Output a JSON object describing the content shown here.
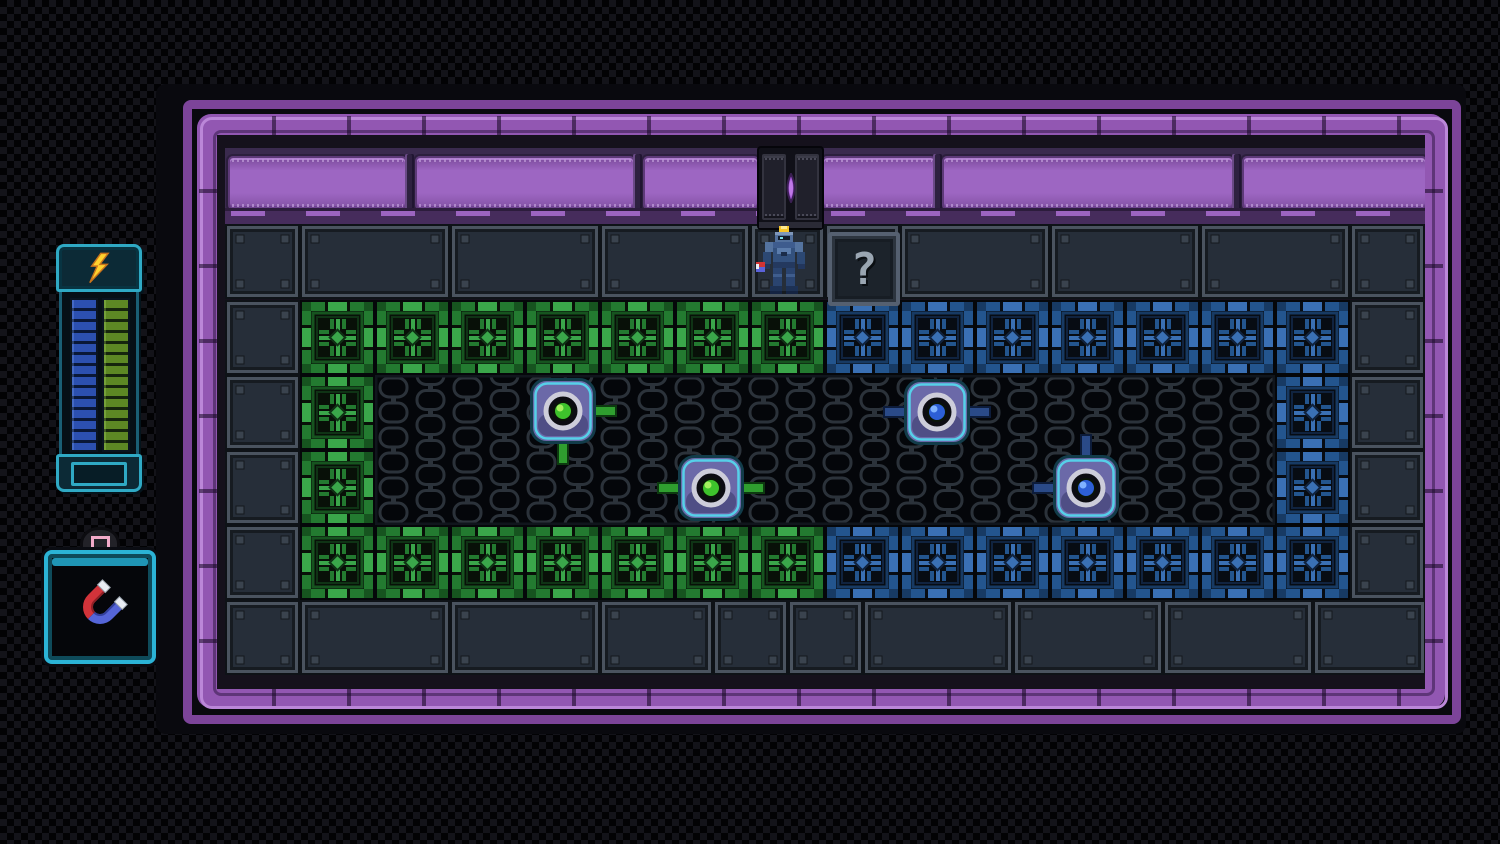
{
  "game": {
    "player": {
      "sprite": "armored-robot",
      "holding": "magnet"
    },
    "mystery_block": {
      "glyph": "?"
    },
    "door": {
      "position": "top-center",
      "state": "closed"
    },
    "orbs": [
      {
        "id": "green-orb-1",
        "core": "green",
        "x": 155,
        "y": 3,
        "connectors": [
          "right",
          "down"
        ]
      },
      {
        "id": "green-orb-2",
        "core": "green",
        "x": 303,
        "y": 80,
        "connectors": [
          "left",
          "right"
        ]
      },
      {
        "id": "blue-orb-1",
        "core": "blue",
        "x": 529,
        "y": 4,
        "connectors": [
          "left",
          "right"
        ]
      },
      {
        "id": "blue-orb-2",
        "core": "blue",
        "x": 678,
        "y": 80,
        "connectors": [
          "up",
          "left"
        ]
      }
    ],
    "hud": {
      "energy_meter": {
        "icon": "lightning-bolt",
        "columns": [
          {
            "name": "blue-energy",
            "color": "#2c50b0"
          },
          {
            "name": "green-energy",
            "color": "#5d8824"
          }
        ]
      },
      "item": {
        "name": "magnet",
        "icon": "magnet",
        "button_icon": "pink-square-button"
      }
    }
  },
  "layout": {
    "unit": 75,
    "rows": {
      "top": [
        {
          "t": "grey",
          "w": 1
        },
        {
          "t": "grey",
          "w": 2
        },
        {
          "t": "grey",
          "w": 2
        },
        {
          "t": "grey",
          "w": 2
        },
        {
          "t": "grey",
          "w": 1
        },
        {
          "t": "grey",
          "w": 1
        },
        {
          "t": "grey",
          "w": 2
        },
        {
          "t": "grey",
          "w": 2
        },
        {
          "t": "grey",
          "w": 2
        },
        {
          "t": "grey",
          "w": 1
        }
      ],
      "upper": [
        {
          "t": "grey",
          "w": 1
        },
        {
          "t": "green",
          "w": 1,
          "n": 7
        },
        {
          "t": "blue",
          "w": 1,
          "n": 7
        },
        {
          "t": "grey",
          "w": 1
        }
      ],
      "lower": [
        {
          "t": "grey",
          "w": 1
        },
        {
          "t": "green",
          "w": 1,
          "n": 7
        },
        {
          "t": "blue",
          "w": 1,
          "n": 7
        },
        {
          "t": "grey",
          "w": 1
        }
      ],
      "bottom": [
        {
          "t": "grey",
          "w": 1
        },
        {
          "t": "grey",
          "w": 2
        },
        {
          "t": "grey",
          "w": 2
        },
        {
          "t": "grey",
          "w": 1.5
        },
        {
          "t": "grey",
          "w": 1
        },
        {
          "t": "grey",
          "w": 1
        },
        {
          "t": "grey",
          "w": 2
        },
        {
          "t": "grey",
          "w": 2
        },
        {
          "t": "grey",
          "w": 2
        },
        {
          "t": "grey",
          "w": 1.5
        }
      ]
    },
    "middle_left_columns": [
      "grey",
      "green"
    ],
    "middle_right_columns": [
      "blue",
      "grey"
    ],
    "banner_panels": [
      {
        "x": 3,
        "w": 175
      },
      {
        "x": 190,
        "w": 216
      },
      {
        "x": 418,
        "w": 112
      },
      {
        "x": 597,
        "w": 110
      },
      {
        "x": 717,
        "w": 288
      },
      {
        "x": 1017,
        "w": 181
      }
    ]
  },
  "palette": {
    "background_checker": [
      "#020204",
      "#131319"
    ],
    "pipe_purple": "#9257b2",
    "pipe_highlight": "#bb87d8",
    "pipe_shadow": "#5e3578",
    "pipe_outer": "#7c4499",
    "interior_bg": "#15111c",
    "banner_bg": "#3a2a4e",
    "banner_panel": "#9d66c2",
    "banner_ledge": "#462c5c",
    "grey_tile": {
      "bg": "#0e1217",
      "frame": "#4a535f",
      "inner": "#161b21",
      "fill": "#262e39",
      "bolt": "#3a434e"
    },
    "green_tile": {
      "bg": "#081008",
      "frame": "#16541f",
      "bright": "#3aa64a",
      "mid": "#237a30",
      "dark": "#0f3315"
    },
    "blue_tile": {
      "bg": "#070c13",
      "frame": "#173a63",
      "bright": "#3a70b4",
      "mid": "#23558e",
      "dark": "#10233f"
    },
    "mesh": {
      "bg": "#04060a",
      "line": "#2b323a"
    },
    "orb": {
      "body": "#6b69a8",
      "edge": "#54dcef",
      "edge_dark": "#123c4a",
      "ring": "#cdcdda",
      "socket": "#0c0c12",
      "green_core": "#3ec22c",
      "green_core_hi": "#a5ef5f",
      "green_link": "#2f9e2f",
      "green_link_dark": "#0d3a10",
      "blue_core": "#2d5fd6",
      "blue_core_hi": "#7fb2ff",
      "blue_link": "#2a4a88",
      "blue_link_dark": "#0d1c3a"
    },
    "door": {
      "frame": "#101018",
      "panel": "#20202b",
      "lens": "#a355d6"
    },
    "hud": {
      "teal": "#2fa9c4",
      "teal_dark": "#17606f",
      "blue_seg": "#2c50b0",
      "green_seg": "#5d8824",
      "bolt_yellow": "#ffd22e",
      "magnet_red": "#d2333a",
      "magnet_blue": "#5565d8",
      "button_pink": "#f2aac9"
    }
  }
}
